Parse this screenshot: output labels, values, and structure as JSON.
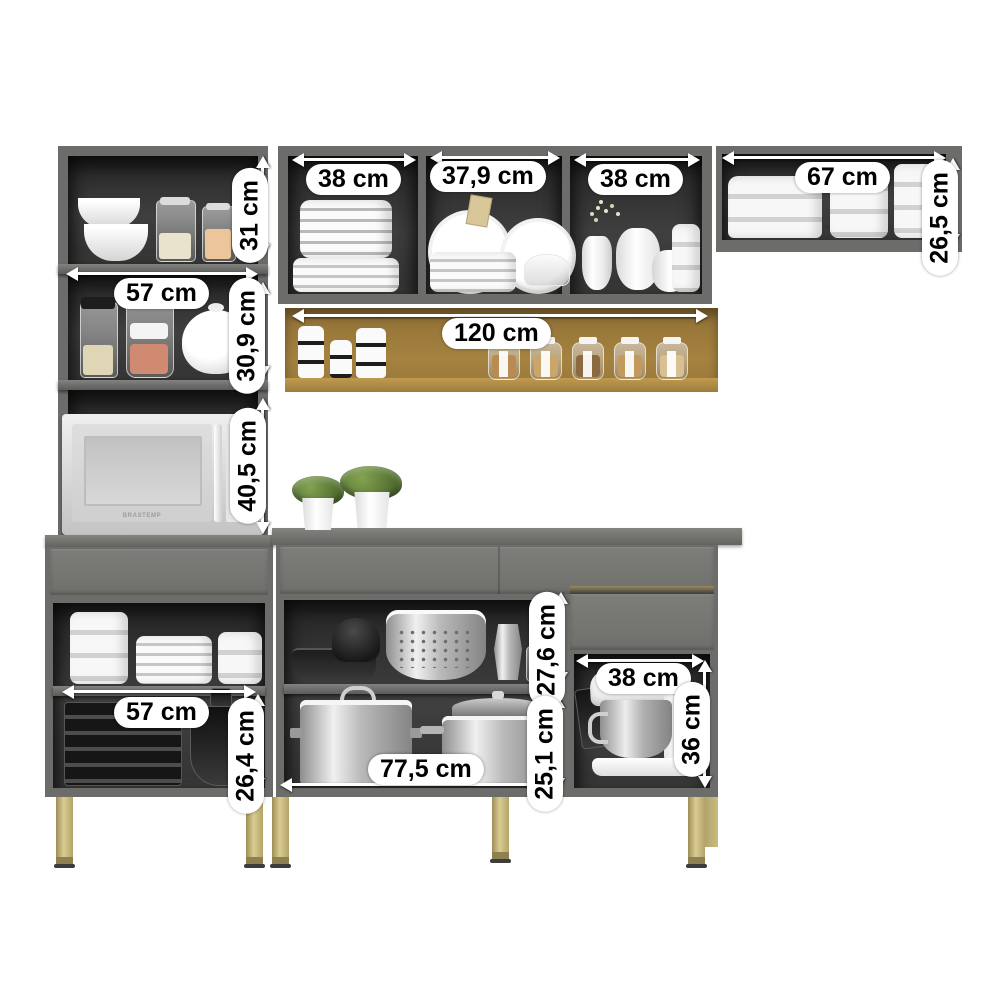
{
  "units": "cm",
  "microwave": {
    "brand": "BRASTEMP"
  },
  "colors": {
    "cabinet_gray": "#6c6c6a",
    "drawer_panel": "#787874",
    "interior_dark": "#3a3a3a",
    "wood_shelf": "#a5823f",
    "leg_gold": "#c9ba7e",
    "label_bg": "#ffffff",
    "label_text": "#000000"
  },
  "measurements": [
    {
      "id": "wall-cabinet-left-section-width",
      "label": "38 cm",
      "orientation": "horizontal"
    },
    {
      "id": "wall-cabinet-middle-section-width",
      "label": "37,9 cm",
      "orientation": "horizontal"
    },
    {
      "id": "wall-cabinet-right-section-width",
      "label": "38 cm",
      "orientation": "horizontal"
    },
    {
      "id": "upper-right-cabinet-width",
      "label": "67 cm",
      "orientation": "horizontal"
    },
    {
      "id": "tower-top-shelf-height",
      "label": "31 cm",
      "orientation": "vertical"
    },
    {
      "id": "upper-right-cabinet-height",
      "label": "26,5 cm",
      "orientation": "vertical"
    },
    {
      "id": "tower-shelf-width",
      "label": "57 cm",
      "orientation": "horizontal"
    },
    {
      "id": "tower-middle-shelf-height",
      "label": "30,9 cm",
      "orientation": "vertical"
    },
    {
      "id": "open-shelf-width",
      "label": "120 cm",
      "orientation": "horizontal"
    },
    {
      "id": "microwave-niche-height",
      "label": "40,5 cm",
      "orientation": "vertical"
    },
    {
      "id": "base-left-shelf-width",
      "label": "57 cm",
      "orientation": "horizontal"
    },
    {
      "id": "base-left-shelf-height",
      "label": "26,4 cm",
      "orientation": "vertical"
    },
    {
      "id": "base-middle-upper-height",
      "label": "27,6 cm",
      "orientation": "vertical"
    },
    {
      "id": "base-middle-lower-height",
      "label": "25,1 cm",
      "orientation": "vertical"
    },
    {
      "id": "base-middle-width",
      "label": "77,5 cm",
      "orientation": "horizontal"
    },
    {
      "id": "mixer-niche-width",
      "label": "38 cm",
      "orientation": "horizontal"
    },
    {
      "id": "mixer-niche-height",
      "label": "36 cm",
      "orientation": "vertical"
    }
  ],
  "scene": {
    "description": "kitchen cabinet set product render with dimension callouts",
    "sections": [
      "left-tall-tower",
      "middle-wall-cabinet",
      "upper-right-wall-cabinet",
      "wooden-open-shelf",
      "left-base-cabinet",
      "main-base-cabinet",
      "mixer-compartment"
    ],
    "items": [
      "white-bowls",
      "storage-jars",
      "teapot",
      "microwave",
      "ruffled-bowl-stack",
      "plate-stacks",
      "large-plates",
      "butter-dish",
      "pitchers",
      "flower-vase",
      "striped-canisters",
      "spice-jars",
      "white-containers",
      "potted-plants",
      "glass-bakeware",
      "glass-bowls",
      "dark-pan",
      "citrus-juicer",
      "colander",
      "glass-mugs",
      "stainless-pots",
      "stand-mixer",
      "gold-legs"
    ]
  }
}
